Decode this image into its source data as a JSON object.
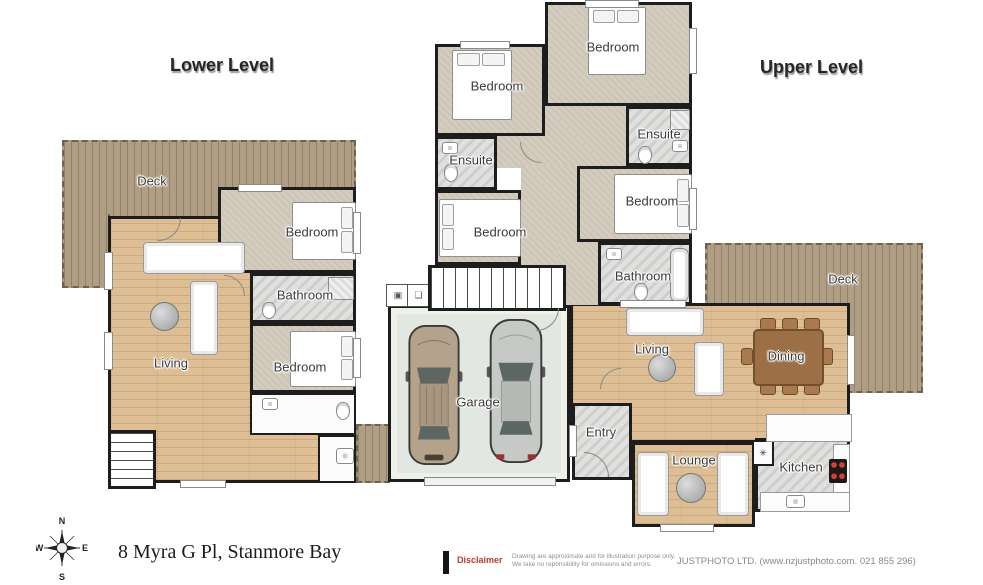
{
  "titles": {
    "lower": "Lower Level",
    "upper": "Upper Level"
  },
  "rooms": {
    "lower_deck": "Deck",
    "lower_living": "Living",
    "lower_bedroom_top": "Bedroom",
    "lower_bathroom": "Bathroom",
    "lower_bedroom_bottom": "Bedroom",
    "upper_bedroom_nw": "Bedroom",
    "upper_bedroom_n": "Bedroom",
    "upper_ensuite_w": "Ensuite",
    "upper_ensuite_e": "Ensuite",
    "upper_bedroom_w": "Bedroom",
    "upper_bedroom_e": "Bedroom",
    "upper_bathroom": "Bathroom",
    "garage": "Garage",
    "living": "Living",
    "dining": "Dining",
    "entry": "Entry",
    "lounge": "Lounge",
    "kitchen": "Kitchen",
    "upper_deck": "Deck",
    "symbol_star": "✳"
  },
  "compass": {
    "north": "N",
    "east": "E",
    "south": "S",
    "west": "W"
  },
  "footer": {
    "address": "8 Myra G Pl, Stanmore Bay",
    "disclaimer_label": "Disclaimer",
    "disclaimer_line1": "Drawing are approximate and for illustration purpose only.",
    "disclaimer_line2": "We take no reponsibility for omissions and errors.",
    "credit": "JUSTPHOTO LTD. (www.nzjustphoto.com. 021 855 296)"
  },
  "colors": {
    "wall": "#1d1d1d",
    "deck": "#af9e84",
    "wood_floor": "#debf95",
    "carpet": "#d4cdbf",
    "tile": "#e0e0de",
    "garage_floor": "#e3e7e1",
    "dining_table": "#9c6f46",
    "disclaimer_red": "#c0392b",
    "stove_burner_red": "#d8402e"
  }
}
